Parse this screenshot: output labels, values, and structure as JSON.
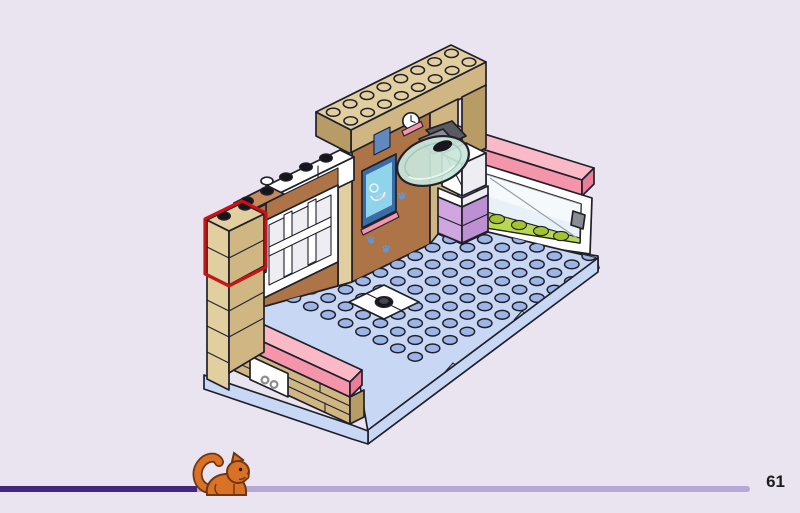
{
  "page": {
    "number": "61",
    "background_color": "#eae4f1"
  },
  "progress_bar": {
    "completed_fraction": 0.246,
    "track_end_fraction": 0.937,
    "completed_color": "#422680",
    "remaining_color": "#b7a9d7"
  },
  "footer": {
    "cat_icon_color": "#d97127"
  },
  "illustration": {
    "type": "lego-assembly-step",
    "description": "Isometric LEGO room build: tan walls with X-ray screen and clock stickers, exam lamp, pink rails, window with greenery, blue studded floor with pet bowl; red outline marks placement of a tan 1x2 brick on the left column",
    "highlight_color": "#cd1216",
    "palette": {
      "bg": "#eae4f1",
      "outline": "#20202a",
      "text": "#1d1d1f",
      "tan_light": "#e2cfa0",
      "tan_mid": "#cfb682",
      "tan_dark": "#b89c66",
      "brown_light": "#c38a5d",
      "brown_mid": "#ad7448",
      "brown_dark": "#8f5a33",
      "plate": "#c8d8f4",
      "plate_edge": "#e0e9fa",
      "stud_blue": "#9db5e6",
      "pink_light": "#f9b9c7",
      "pink_mid": "#f595ab",
      "pink_dark": "#ec7d98",
      "lavender_light": "#cfa6e0",
      "lavender_mid": "#bc90d2",
      "white": "#ffffff",
      "white_shade": "#ededf2",
      "glass": "#c9e5da",
      "glass_rim": "#9fcabd",
      "gray_dark": "#5a5a62",
      "gray_mid": "#8b8b94",
      "green_fill": "#b9d851",
      "green_stud": "#a2c433",
      "screen_frame": "#3a6ca6",
      "screen_glow": "#8fd4ea",
      "sticker_blue": "#6189c0",
      "paw_blue": "#5c97d8",
      "highlight_red": "#cd1216",
      "bar_done": "#422680",
      "bar_rest": "#b7a9d7",
      "cat_orange": "#d97127",
      "cat_outline": "#6f3611"
    }
  }
}
